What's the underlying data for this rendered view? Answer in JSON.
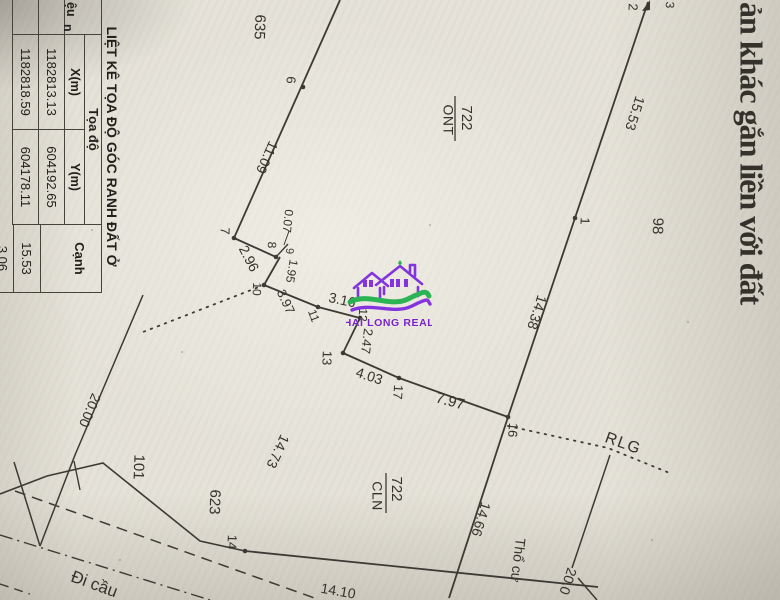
{
  "document": {
    "title_fragment": "ản khác gắn liền với đất"
  },
  "watermark": {
    "brand": "HAI LONG REAL"
  },
  "table": {
    "title": "LIỆT KÊ TỌA ĐỘ GÓC RANH ĐẤT Ở",
    "header": {
      "id_fragment_line1": "ệu",
      "id_fragment_line2": "n",
      "coord_group": "Tọa độ",
      "x": "X(m)",
      "y": "Y(m)",
      "edge": "Cạnh"
    },
    "rows": [
      {
        "x": "1182813.13",
        "y": "604192.65"
      },
      {
        "x": "1182818.59",
        "y": "604178.11"
      }
    ],
    "edge_values": [
      "15.53",
      "3.06"
    ]
  },
  "diagram": {
    "labels": [
      {
        "n": "doc-title-fragment",
        "t": "ản khác gắn liền với đất",
        "x": 748,
        "y": 2,
        "r": 90,
        "s": 32,
        "b": 1,
        "f": 1,
        "a": "start",
        "ls": -1
      },
      {
        "n": "parcel-635",
        "t": "635",
        "x": 259,
        "y": 27,
        "r": 92,
        "s": 15
      },
      {
        "n": "parcel-98",
        "t": "98",
        "x": 657,
        "y": 226,
        "r": 92,
        "s": 15
      },
      {
        "n": "parcel-101",
        "t": "101",
        "x": 138,
        "y": 467,
        "r": 92,
        "s": 15
      },
      {
        "n": "parcel-623",
        "t": "623",
        "x": 214,
        "y": 502,
        "r": 92,
        "s": 15
      },
      {
        "n": "parcel-722-ont-num",
        "t": "722",
        "x": 466,
        "y": 118,
        "r": 90,
        "s": 15
      },
      {
        "n": "parcel-722-ont-type",
        "t": "ONT",
        "x": 447,
        "y": 120,
        "r": 90,
        "s": 14,
        "ls": 0.5
      },
      {
        "n": "parcel-722-cln-num",
        "t": "722",
        "x": 396,
        "y": 489,
        "r": 90,
        "s": 15
      },
      {
        "n": "parcel-722-cln-type",
        "t": "CLN",
        "x": 376,
        "y": 496,
        "r": 90,
        "s": 14,
        "ls": 0.5
      },
      {
        "n": "land-type-tho-cu",
        "t": "Thổ cư",
        "x": 517,
        "y": 560,
        "r": 97,
        "s": 14
      },
      {
        "n": "boundary-rlg",
        "t": "RLG",
        "x": 623,
        "y": 444,
        "r": 20,
        "s": 16,
        "ls": 1.5
      },
      {
        "n": "road-name-di-cau",
        "t": "Đi cầu",
        "x": 94,
        "y": 585,
        "r": 20,
        "s": 17
      },
      {
        "n": "dim-15-53",
        "t": "15.53",
        "x": 634,
        "y": 113,
        "r": 108,
        "s": 14
      },
      {
        "n": "dim-14-38",
        "t": "14.38",
        "x": 536,
        "y": 312,
        "r": 108,
        "s": 14
      },
      {
        "n": "dim-11-09",
        "t": "11.09",
        "x": 266,
        "y": 157,
        "r": 114,
        "s": 14
      },
      {
        "n": "dim-2-96",
        "t": "2.96",
        "x": 248,
        "y": 259,
        "r": 63,
        "s": 14
      },
      {
        "n": "dim-0-07",
        "t": "0.07",
        "x": 287,
        "y": 221,
        "r": 96,
        "s": 12
      },
      {
        "n": "dim-1-95",
        "t": "1.95",
        "x": 291,
        "y": 271,
        "r": 100,
        "s": 12
      },
      {
        "n": "dim-3-97",
        "t": "3.97",
        "x": 285,
        "y": 302,
        "r": 65,
        "s": 13
      },
      {
        "n": "dim-3-16",
        "t": "3.16",
        "x": 342,
        "y": 301,
        "r": 12,
        "s": 14
      },
      {
        "n": "dim-2-47",
        "t": "2.47",
        "x": 366,
        "y": 341,
        "r": 97,
        "s": 13
      },
      {
        "n": "dim-4-03",
        "t": "4.03",
        "x": 369,
        "y": 377,
        "r": 18,
        "s": 14
      },
      {
        "n": "dim-7-97",
        "t": "7.97",
        "x": 450,
        "y": 402,
        "r": 15,
        "s": 15
      },
      {
        "n": "dim-14-10",
        "t": "14.10",
        "x": 338,
        "y": 592,
        "r": 10,
        "s": 14
      },
      {
        "n": "dim-14-73",
        "t": "14.73",
        "x": 277,
        "y": 451,
        "r": 115,
        "s": 14
      },
      {
        "n": "dim-14-66",
        "t": "14.66",
        "x": 480,
        "y": 519,
        "r": 107,
        "s": 14
      },
      {
        "n": "dim-20-00-left",
        "t": "20.00",
        "x": 89,
        "y": 410,
        "r": 113,
        "s": 14
      },
      {
        "n": "dim-20-0-right",
        "t": "20.0",
        "x": 567,
        "y": 581,
        "r": 108,
        "s": 14
      },
      {
        "n": "vertex-1",
        "t": "1",
        "x": 584,
        "y": 221,
        "r": 92,
        "s": 13
      },
      {
        "n": "vertex-2",
        "t": "2",
        "x": 632,
        "y": 7,
        "r": 92,
        "s": 13
      },
      {
        "n": "vertex-3",
        "t": "3",
        "x": 669,
        "y": 5,
        "r": 92,
        "s": 12
      },
      {
        "n": "vertex-6",
        "t": "6",
        "x": 290,
        "y": 80,
        "r": 92,
        "s": 13
      },
      {
        "n": "vertex-7",
        "t": "7",
        "x": 224,
        "y": 231,
        "r": 92,
        "s": 13
      },
      {
        "n": "vertex-8",
        "t": "8",
        "x": 271,
        "y": 245,
        "r": 92,
        "s": 12
      },
      {
        "n": "vertex-9",
        "t": "9",
        "x": 289,
        "y": 251,
        "r": 92,
        "s": 11
      },
      {
        "n": "vertex-10",
        "t": "10",
        "x": 256,
        "y": 289,
        "r": 92,
        "s": 12
      },
      {
        "n": "vertex-11",
        "t": "11",
        "x": 313,
        "y": 316,
        "r": 70,
        "s": 12
      },
      {
        "n": "vertex-12",
        "t": "12",
        "x": 362,
        "y": 315,
        "r": 92,
        "s": 12
      },
      {
        "n": "vertex-13",
        "t": "13",
        "x": 326,
        "y": 358,
        "r": 92,
        "s": 13
      },
      {
        "n": "vertex-14",
        "t": "14",
        "x": 231,
        "y": 542,
        "r": 92,
        "s": 13
      },
      {
        "n": "vertex-16",
        "t": "16",
        "x": 512,
        "y": 430,
        "r": 95,
        "s": 13
      },
      {
        "n": "vertex-17",
        "t": "17",
        "x": 397,
        "y": 392,
        "r": 95,
        "s": 13
      }
    ]
  }
}
